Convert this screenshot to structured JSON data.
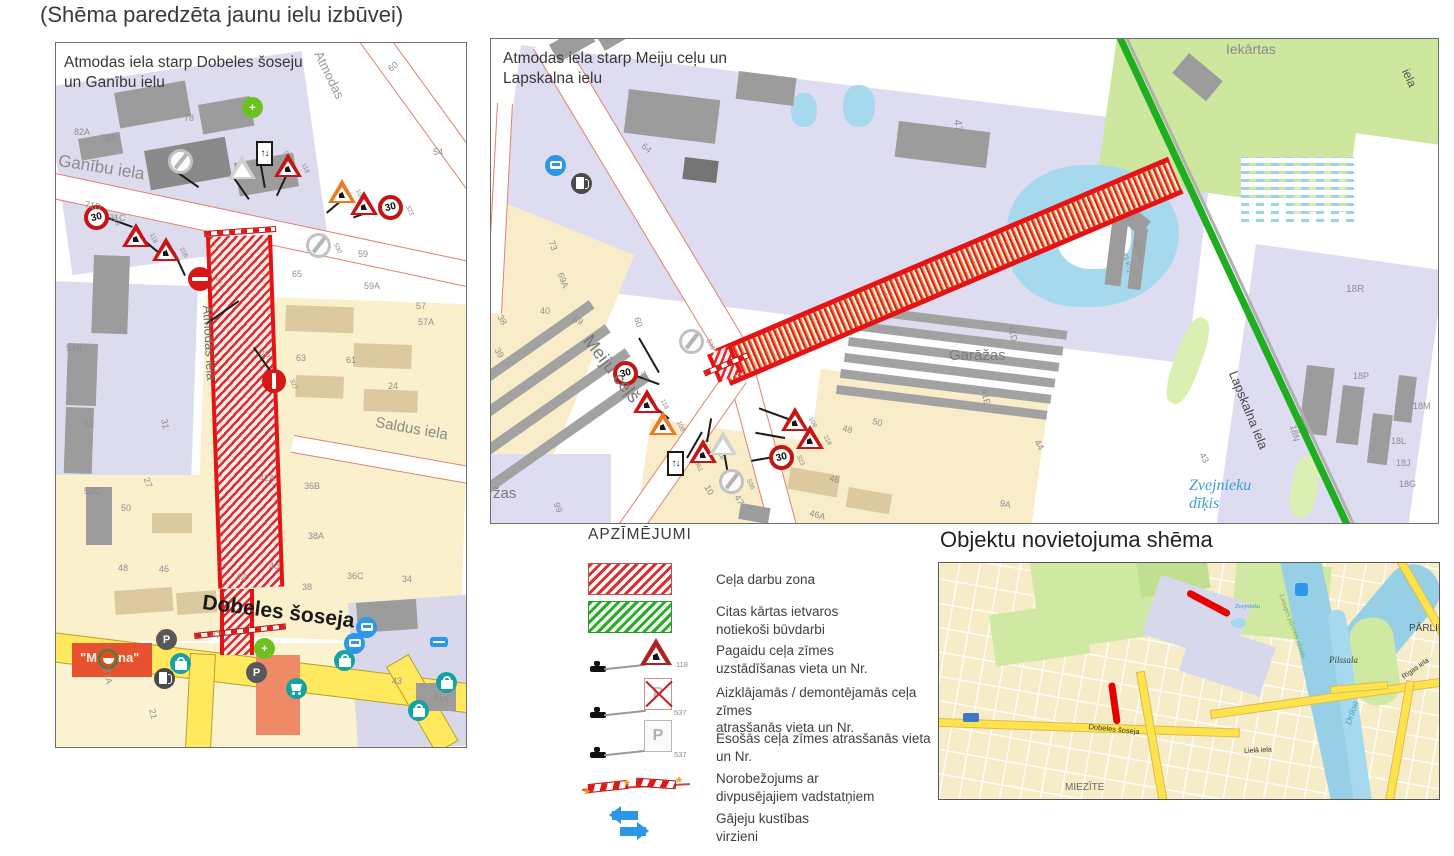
{
  "page": {
    "title": "(Shēma paredzēta jaunu ielu izbūvei)"
  },
  "colors": {
    "work_zone_red": "#d81818",
    "other_phase_green": "#1fae1f",
    "road_yellow": "#ffe95e",
    "water_blue": "#a6d9ee",
    "pedestrian_arrow_blue": "#2c96e8"
  },
  "map_left": {
    "title": "Atmodas iela starp Dobeles šoseju\nun Ganību ielu",
    "labels": [
      {
        "t": "Ganību iela",
        "x": 4,
        "y": 108,
        "r": 9,
        "s": 17,
        "c": "#8a8a8a",
        "n": "street-label-ganibu"
      },
      {
        "t": "Atmodas",
        "x": 268,
        "y": 6,
        "r": 64,
        "s": 13,
        "c": "#999999",
        "n": "street-label-atmodas-upper"
      },
      {
        "t": "Atmodas iela",
        "x": 158,
        "y": 262,
        "r": 87,
        "s": 13,
        "c": "#6f6f6f",
        "n": "street-label-atmodas"
      },
      {
        "t": "Dobeles šoseja",
        "x": 148,
        "y": 548,
        "r": 7,
        "s": 21,
        "c": "#1a1a1a",
        "b": 1,
        "n": "street-label-dobeles"
      },
      {
        "t": "Saldus iela",
        "x": 321,
        "y": 371,
        "r": 10,
        "s": 15,
        "c": "#8a8a8a",
        "n": "street-label-saldus"
      },
      {
        "t": "82A",
        "x": 18,
        "y": 84
      },
      {
        "t": "78A",
        "x": 44,
        "y": 90
      },
      {
        "t": "78",
        "x": 128,
        "y": 70
      },
      {
        "t": "60",
        "x": 330,
        "y": 23,
        "r": -40
      },
      {
        "t": "54",
        "x": 377,
        "y": 104
      },
      {
        "t": "71D",
        "x": 30,
        "y": 156,
        "r": 12
      },
      {
        "t": "71C",
        "x": 53,
        "y": 170
      },
      {
        "t": "59",
        "x": 302,
        "y": 206
      },
      {
        "t": "65",
        "x": 236,
        "y": 226
      },
      {
        "t": "59A",
        "x": 308,
        "y": 238
      },
      {
        "t": "57",
        "x": 360,
        "y": 258
      },
      {
        "t": "57A",
        "x": 362,
        "y": 274
      },
      {
        "t": "26",
        "x": 204,
        "y": 306
      },
      {
        "t": "63",
        "x": 240,
        "y": 310
      },
      {
        "t": "61",
        "x": 290,
        "y": 312
      },
      {
        "t": "24",
        "x": 332,
        "y": 338
      },
      {
        "t": "31",
        "x": 113,
        "y": 375,
        "r": 78
      },
      {
        "t": "27",
        "x": 95,
        "y": 433,
        "r": 70
      },
      {
        "t": "54B",
        "x": 10,
        "y": 300
      },
      {
        "t": "52",
        "x": 28,
        "y": 376
      },
      {
        "t": "52C",
        "x": 28,
        "y": 443
      },
      {
        "t": "50",
        "x": 65,
        "y": 460
      },
      {
        "t": "42A",
        "x": 203,
        "y": 430
      },
      {
        "t": "36B",
        "x": 248,
        "y": 438
      },
      {
        "t": "38A",
        "x": 252,
        "y": 488
      },
      {
        "t": "48",
        "x": 62,
        "y": 520
      },
      {
        "t": "46",
        "x": 103,
        "y": 521
      },
      {
        "t": "42",
        "x": 180,
        "y": 529
      },
      {
        "t": "40",
        "x": 213,
        "y": 518
      },
      {
        "t": "38",
        "x": 246,
        "y": 539
      },
      {
        "t": "36C",
        "x": 291,
        "y": 528
      },
      {
        "t": "34",
        "x": 346,
        "y": 531
      },
      {
        "t": "47",
        "x": 156,
        "y": 586,
        "r": 12
      },
      {
        "t": "43",
        "x": 336,
        "y": 633
      },
      {
        "t": "41A",
        "x": 378,
        "y": 649,
        "r": 12
      },
      {
        "t": "21",
        "x": 101,
        "y": 665,
        "r": 78
      },
      {
        "t": "21A",
        "x": 55,
        "y": 624,
        "r": 78
      },
      {
        "t": "\"M",
        "x": 24,
        "y": 608,
        "s": 13,
        "c": "#fdf0e8",
        "b": 1,
        "n": "store-banner-label"
      },
      {
        "t": "na\"",
        "x": 62,
        "y": 608,
        "s": 13,
        "c": "#fdf0e8",
        "b": 1,
        "n": "store-banner-label"
      }
    ],
    "signs": [
      {
        "t": "gray",
        "x": 112,
        "y": 106,
        "n": "530"
      },
      {
        "t": "whitetri",
        "x": 172,
        "y": 112
      },
      {
        "t": "rect",
        "x": 200,
        "y": 98,
        "v": "↑↓",
        "n": "519"
      },
      {
        "t": "redtri",
        "x": 218,
        "y": 110,
        "n": "118"
      },
      {
        "t": "orangetri",
        "x": 272,
        "y": 136,
        "n": "108"
      },
      {
        "t": "redtri",
        "x": 294,
        "y": 148,
        "n": "116"
      },
      {
        "t": "s30",
        "x": 322,
        "y": 152,
        "v": "30",
        "n": "323"
      },
      {
        "t": "gray",
        "x": 250,
        "y": 190,
        "n": "530"
      },
      {
        "t": "s30",
        "x": 28,
        "y": 162,
        "v": "30",
        "n": "323"
      },
      {
        "t": "redtri",
        "x": 66,
        "y": 180,
        "n": "118"
      },
      {
        "t": "redtri",
        "x": 96,
        "y": 194,
        "n": "108"
      },
      {
        "t": "noentry",
        "x": 132,
        "y": 224,
        "n": "301"
      },
      {
        "t": "nostopv",
        "x": 206,
        "y": 326,
        "n": "327"
      }
    ],
    "pois": [
      {
        "t": "pharm",
        "x": 186,
        "y": 54,
        "g": "+"
      },
      {
        "t": "store",
        "x": 42,
        "y": 606
      },
      {
        "t": "p",
        "x": 100,
        "y": 586,
        "g": "P"
      },
      {
        "t": "bag",
        "x": 114,
        "y": 610
      },
      {
        "t": "fuel",
        "x": 98,
        "y": 625
      },
      {
        "t": "p",
        "x": 190,
        "y": 619,
        "g": "P"
      },
      {
        "t": "pharm",
        "x": 198,
        "y": 595,
        "g": "+"
      },
      {
        "t": "cart",
        "x": 230,
        "y": 635
      },
      {
        "t": "bag",
        "x": 278,
        "y": 607
      },
      {
        "t": "bus",
        "x": 300,
        "y": 574
      },
      {
        "t": "bus",
        "x": 288,
        "y": 590
      },
      {
        "t": "dash",
        "x": 374,
        "y": 594
      },
      {
        "t": "bag",
        "x": 380,
        "y": 629
      },
      {
        "t": "bag",
        "x": 352,
        "y": 657
      }
    ]
  },
  "map_right": {
    "title": "Atmodas iela starp Meiju ceļu un\nLapskalna ielu",
    "labels": [
      {
        "t": "Meiju ceļš",
        "x": 104,
        "y": 292,
        "r": 52,
        "s": 18,
        "c": "#777777",
        "n": "street-label-meiju"
      },
      {
        "t": "Iekārtas",
        "x": 735,
        "y": 2,
        "s": 14,
        "c": "#8a8a8a",
        "n": "area-label-iekartas"
      },
      {
        "t": "Garāžas",
        "x": 458,
        "y": 308,
        "s": 15,
        "c": "#7a7a7a",
        "n": "area-label-garazas"
      },
      {
        "t": "žas",
        "x": 2,
        "y": 446,
        "s": 15,
        "c": "#7a7a7a",
        "n": "area-label-garazas-2"
      },
      {
        "t": "Zvejnieku\ndīķis",
        "x": 698,
        "y": 438,
        "s": 16,
        "c": "#3aa0d8",
        "i": 1,
        "n": "water-label-zvejnieku"
      },
      {
        "t": "Lapskalna iela",
        "x": 748,
        "y": 330,
        "r": 68,
        "s": 13,
        "c": "#4a4a4a",
        "n": "street-label-lapskalna"
      },
      {
        "t": "iela",
        "x": 920,
        "y": 28,
        "r": 66,
        "s": 12,
        "c": "#555555",
        "n": "street-label-right"
      },
      {
        "t": "47",
        "x": 472,
        "y": 80,
        "r": 85,
        "s": 11
      },
      {
        "t": "64",
        "x": 155,
        "y": 102,
        "r": 40
      },
      {
        "t": "73",
        "x": 65,
        "y": 200,
        "r": 70
      },
      {
        "t": "69A",
        "x": 74,
        "y": 232,
        "r": 70
      },
      {
        "t": "40",
        "x": 49,
        "y": 267
      },
      {
        "t": "69",
        "x": 84,
        "y": 275,
        "r": 20
      },
      {
        "t": "38",
        "x": 13,
        "y": 274,
        "r": 60
      },
      {
        "t": "39",
        "x": 10,
        "y": 307,
        "r": 60
      },
      {
        "t": "60",
        "x": 151,
        "y": 277,
        "r": 75
      },
      {
        "t": "99",
        "x": 70,
        "y": 462,
        "r": 70
      },
      {
        "t": "10",
        "x": 220,
        "y": 444,
        "r": 60
      },
      {
        "t": "47",
        "x": 250,
        "y": 454,
        "r": 60
      },
      {
        "t": "46A",
        "x": 320,
        "y": 469,
        "r": 15
      },
      {
        "t": "46",
        "x": 340,
        "y": 434,
        "r": 15
      },
      {
        "t": "48",
        "x": 353,
        "y": 384,
        "r": 15
      },
      {
        "t": "50",
        "x": 383,
        "y": 377,
        "r": 15
      },
      {
        "t": "41D",
        "x": 525,
        "y": 285,
        "r": 78
      },
      {
        "t": "41E",
        "x": 498,
        "y": 349,
        "r": 78
      },
      {
        "t": "44",
        "x": 550,
        "y": 399,
        "r": 60
      },
      {
        "t": "43",
        "x": 715,
        "y": 412,
        "r": 60
      },
      {
        "t": "9A",
        "x": 510,
        "y": 459,
        "r": 12
      },
      {
        "t": "18N",
        "x": 807,
        "y": 385,
        "r": 78
      },
      {
        "t": "18R",
        "x": 855,
        "y": 245,
        "s": 10
      },
      {
        "t": "18P",
        "x": 862,
        "y": 332
      },
      {
        "t": "18M",
        "x": 922,
        "y": 362
      },
      {
        "t": "18L",
        "x": 900,
        "y": 397
      },
      {
        "t": "18J",
        "x": 905,
        "y": 419
      },
      {
        "t": "18G",
        "x": 908,
        "y": 440
      },
      {
        "t": "45 K-1",
        "x": 637,
        "y": 213,
        "r": 78,
        "s": 7
      },
      {
        "t": "45 K-4",
        "x": 648,
        "y": 200,
        "r": 78,
        "s": 7
      }
    ],
    "signs": [
      {
        "t": "gray",
        "x": 188,
        "y": 290,
        "n": "536"
      },
      {
        "t": "s30",
        "x": 122,
        "y": 322,
        "v": "30",
        "n": "323"
      },
      {
        "t": "redtri",
        "x": 142,
        "y": 350,
        "n": "118"
      },
      {
        "t": "orangetri",
        "x": 158,
        "y": 372,
        "n": "108"
      },
      {
        "t": "rect",
        "x": 176,
        "y": 412,
        "v": "↑↓",
        "n": "861"
      },
      {
        "t": "redtri",
        "x": 198,
        "y": 400,
        "n": "118"
      },
      {
        "t": "whitetri",
        "x": 218,
        "y": 392
      },
      {
        "t": "gray",
        "x": 228,
        "y": 430,
        "n": "536"
      },
      {
        "t": "redtri",
        "x": 290,
        "y": 368,
        "n": "108"
      },
      {
        "t": "redtri",
        "x": 305,
        "y": 386,
        "n": "118"
      },
      {
        "t": "s30",
        "x": 278,
        "y": 406,
        "v": "30",
        "n": "323"
      }
    ],
    "pois": [
      {
        "t": "bus",
        "x": 54,
        "y": 116
      },
      {
        "t": "fuel",
        "x": 80,
        "y": 134
      }
    ]
  },
  "overview": {
    "title": "Objektu novietojuma shēma",
    "labels": [
      {
        "t": "PĀRLIE",
        "x": 470,
        "y": 60,
        "s": 10,
        "c": "#444444",
        "n": "area-label-parlielupe"
      },
      {
        "t": "Pilssala",
        "x": 390,
        "y": 92,
        "s": 9,
        "c": "#3f3f3f",
        "i": 1,
        "n": "area-label-pilssala"
      },
      {
        "t": "MIEZĪTE",
        "x": 126,
        "y": 219,
        "s": 10,
        "c": "#6a6a6a",
        "n": "area-label-miezite"
      },
      {
        "t": "Driksa",
        "x": 404,
        "y": 160,
        "r": -72,
        "s": 9,
        "c": "#3a9ccc",
        "i": 1,
        "n": "water-label-driksa"
      },
      {
        "t": "Dobeles šoseja",
        "x": 150,
        "y": 160,
        "r": 6,
        "s": 7.5,
        "c": "#333333",
        "n": "street-label-dobeles-ov"
      },
      {
        "t": "Lielā iela",
        "x": 305,
        "y": 185,
        "r": -3,
        "s": 7,
        "c": "#333333",
        "n": "street-label-liela"
      },
      {
        "t": "Rīgas iela",
        "x": 462,
        "y": 112,
        "r": -35,
        "s": 7,
        "c": "#333333",
        "n": "street-label-rigas"
      },
      {
        "t": "Zvejnieku",
        "x": 296,
        "y": 40,
        "s": 6.5,
        "c": "#3a9ccc",
        "i": 1,
        "n": "water-label-zvejnieku-ov"
      },
      {
        "t": "Lietupes pārenes pļavas",
        "x": 346,
        "y": 30,
        "r": 70,
        "s": 7,
        "c": "#7aa84a",
        "i": 1,
        "n": "area-label-plavas"
      }
    ]
  },
  "legend": {
    "title": "APZĪMĒJUMI",
    "items": [
      {
        "label": "Ceļa darbu zona"
      },
      {
        "label": "Citas kārtas ietvaros\nnotiekoši būvdarbi"
      },
      {
        "label": "Pagaidu ceļa zīmes\nuzstādīšanas vieta un Nr.",
        "num": "118"
      },
      {
        "label": "Aizklājamās / demontējamās ceļa zīmes\natrasšanās vieta un Nr.",
        "num": "537",
        "sign_letter": "P"
      },
      {
        "label": "Esošās ceļa zīmes atrasšanās vieta un Nr.",
        "num": "537",
        "sign_letter": "P"
      },
      {
        "label": "Norobežojums ar\ndivpusējajiem vadstatņiem"
      },
      {
        "label": "Gājeju kustības\nvirzieni"
      }
    ]
  }
}
